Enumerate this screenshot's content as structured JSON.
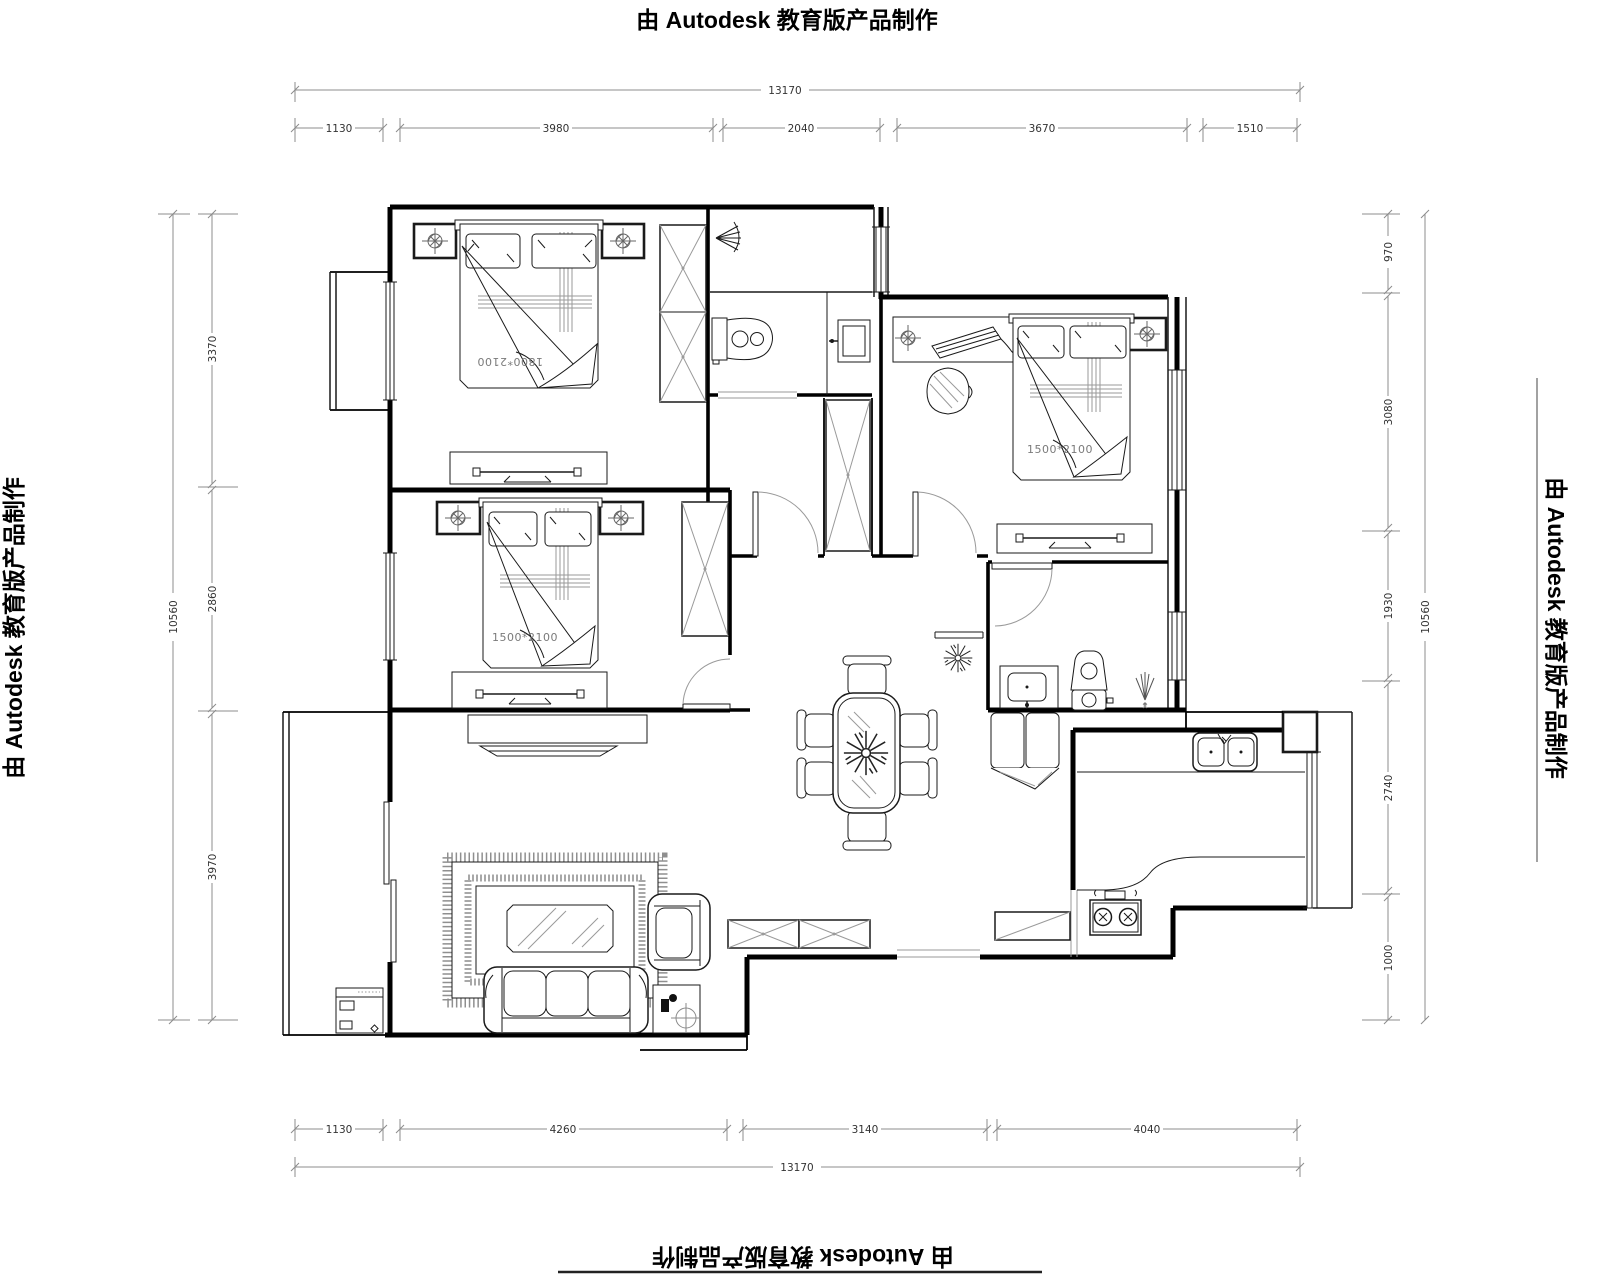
{
  "watermark": {
    "text": "由 Autodesk 教育版产品制作"
  },
  "dimensions": {
    "top": {
      "total": "13170",
      "segments": [
        "1130",
        "3980",
        "2040",
        "3670",
        "1510"
      ]
    },
    "bottom": {
      "total": "13170",
      "segments": [
        "1130",
        "4260",
        "3140",
        "4040"
      ]
    },
    "left": {
      "total": "10560",
      "segments": [
        "3370",
        "2860",
        "3970"
      ]
    },
    "right": {
      "total": "10560",
      "segments": [
        "970",
        "3080",
        "1930",
        "2740",
        "1000"
      ]
    }
  },
  "furniture_labels": {
    "master_bed": "1800*2100",
    "second_bed": "1500*2100",
    "third_bed": "1500*2100"
  },
  "colors": {
    "wall": "#000000",
    "dimension_line": "#8c8c8c",
    "dimension_text": "#333333",
    "furniture_line": "#1a1a1a",
    "accent_gray": "#9a9a9a",
    "label_gray": "#7a7a7a"
  }
}
